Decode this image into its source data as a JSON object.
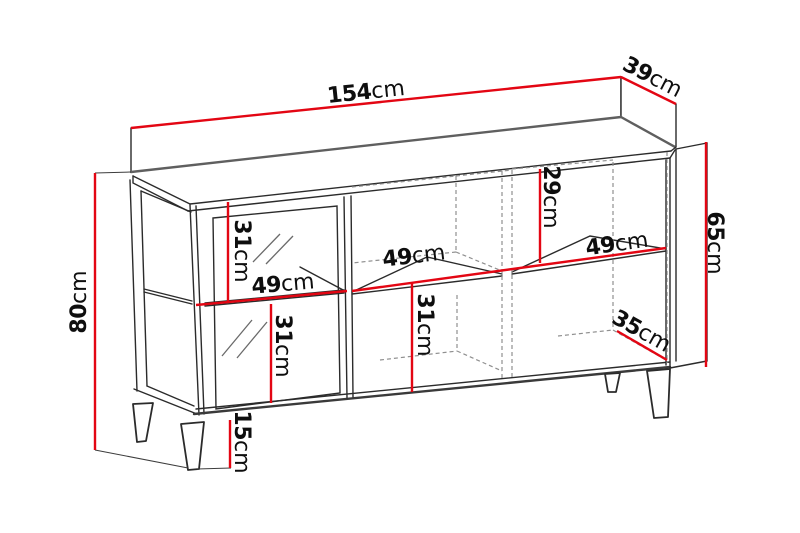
{
  "figure": {
    "type": "furniture-dimension-diagram",
    "subject": "sideboard with glass door, open shelves and angled legs",
    "unit": "cm"
  },
  "colors": {
    "dimension_line": "#e30613",
    "outline": "#2b2b2b",
    "hidden_line": "#8f8f8f",
    "background": "#ffffff",
    "label_text": "#0e0e0e"
  },
  "dimensions": [
    {
      "id": "top-width",
      "value": "154",
      "unit": "cm"
    },
    {
      "id": "top-depth",
      "value": "39",
      "unit": "cm"
    },
    {
      "id": "overall-height",
      "value": "80",
      "unit": "cm"
    },
    {
      "id": "carcass-height",
      "value": "65",
      "unit": "cm"
    },
    {
      "id": "right-upper-height",
      "value": "29",
      "unit": "cm"
    },
    {
      "id": "left-upper-height",
      "value": "31",
      "unit": "cm"
    },
    {
      "id": "left-shelf-width",
      "value": "49",
      "unit": "cm"
    },
    {
      "id": "left-lower-height",
      "value": "31",
      "unit": "cm"
    },
    {
      "id": "middle-shelf-width",
      "value": "49",
      "unit": "cm"
    },
    {
      "id": "middle-lower-height",
      "value": "31",
      "unit": "cm"
    },
    {
      "id": "right-shelf-width",
      "value": "49",
      "unit": "cm"
    },
    {
      "id": "interior-depth",
      "value": "35",
      "unit": "cm"
    },
    {
      "id": "leg-height",
      "value": "15",
      "unit": "cm"
    }
  ]
}
